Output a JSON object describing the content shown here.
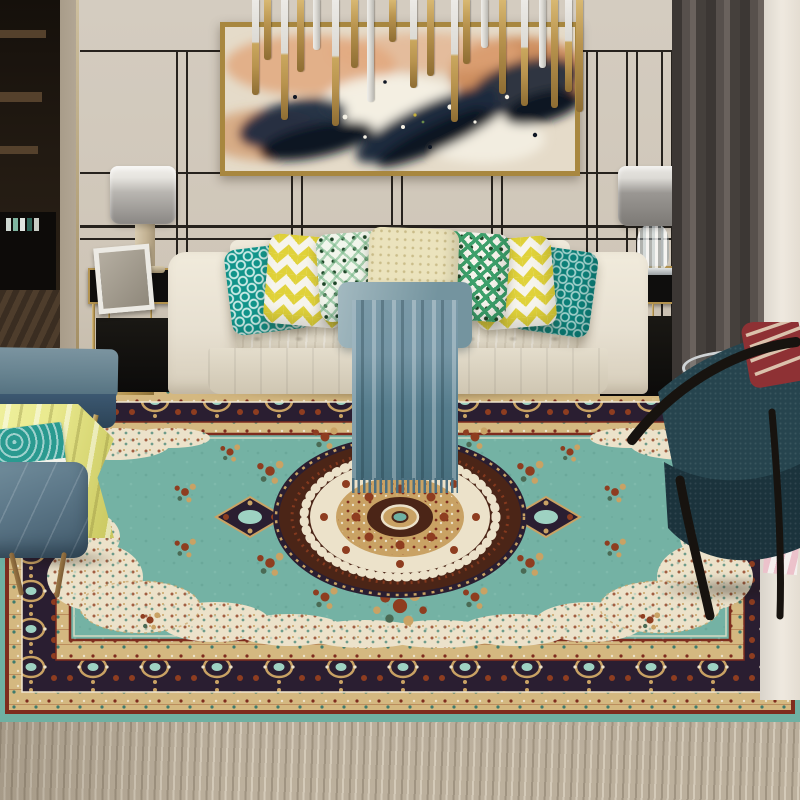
{
  "scene": {
    "title": "Modern living room with teal Persian medallion area rug",
    "objects": [
      {
        "name": "abstract-wall-art",
        "description": "gold-framed abstract painting with navy, peach-orange and white paint splashes"
      },
      {
        "name": "pendant-chandelier",
        "description": "cluster of hanging brass and silver cylindrical rods"
      },
      {
        "name": "wall-panel-trim",
        "description": "cream wall with thin black and gold line moulding"
      },
      {
        "name": "table-lamp-left",
        "description": "drum-shade lamp with alabaster column base on gold side table"
      },
      {
        "name": "table-lamp-right",
        "description": "drum-shade lamp with crystal base on gold side table"
      },
      {
        "name": "photo-frame",
        "description": "small white picture frame on left side table"
      },
      {
        "name": "sofa",
        "description": "cream tufted three-seat sofa"
      },
      {
        "name": "throw-pillows",
        "description": "seven pillows: teal lattice, yellow chevron, green dot-diamond, cream, green diamond, yellow chevron, dark teal lattice"
      },
      {
        "name": "throw-blanket",
        "description": "slate blue draped throw with fringe"
      },
      {
        "name": "area-rug",
        "description": "teal-green Persian rug with ornate cream/maroon center medallion and dark navy floral border"
      },
      {
        "name": "bench-and-stool",
        "description": "blue-gray leather bench and stool with yellow towel and teal book"
      },
      {
        "name": "armchair",
        "description": "dark teal fabric armchair with black wood frame and red striped pillow"
      },
      {
        "name": "magazines",
        "description": "magazines on round glass side table"
      },
      {
        "name": "curtain",
        "description": "dark gray curtain beside bright window sheer"
      },
      {
        "name": "wood-floor",
        "description": "light washed-gray plank flooring"
      }
    ]
  },
  "palette": {
    "wall": "#d4ccc0",
    "wall_shade": "#b3a795",
    "trim_dark": "#26221d",
    "gold": "#b2924e",
    "trim_gold": "#8f7640",
    "door_dark": "#221a12",
    "door_shelf": "#55412c",
    "floor": "#b5a996",
    "floor_dark": "#8e8270",
    "floor_light": "#d8cfbf",
    "curtain": "#49423f",
    "curtain_light": "#6a625d",
    "sheer": "#efe9df",
    "canvas": "#e5dbc9",
    "paint_navy": "#1e2a3e",
    "paint_navy2": "#0e1624",
    "paint_orange": "#c97c44",
    "paint_peach": "#e2a87e",
    "paint_white": "#f4f0e4",
    "frame_gold": "#a8873f",
    "rod_gold": "#b8934e",
    "rod_gold_dark": "#8e6d33",
    "rod_silver": "#dcdad4",
    "shade_light": "#e6e4df",
    "shade_dark": "#8a8784",
    "lamp_column": "#c4b394",
    "table_black": "#0f0e0d",
    "sofa": "#e7e0d1",
    "sofa_shade": "#c9bfab",
    "sofa_dark": "#b5aa94",
    "p_teal": "#11948a",
    "p_teal_dark": "#0c7f78",
    "p_yellow": "#e0d23a",
    "p_white": "#f6f4ec",
    "p_green": "#3da06b",
    "p_green_dark": "#1d4527",
    "p_ltgreen": "#79b98a",
    "p_cream": "#ebe3bd",
    "throw": "#7596a5",
    "throw_dark": "#4d7080",
    "throw_light": "#a3b9c0",
    "rug_selvage": "#6fb0a2",
    "rug_field": "#74b2a4",
    "rug_navy": "#2a1e31",
    "rug_maroon": "#4b2517",
    "rug_cream": "#ece2ca",
    "rug_gold": "#c9a264",
    "rug_beige": "#d4b880",
    "rug_rust": "#8e3d20",
    "rug_red": "#7e2c1e",
    "rug_teal_accent": "#9ed2c2",
    "bench_top": "#66828f",
    "bench_front": "#3c5871",
    "towel": "#e9e98e",
    "towel_dark": "#c9c75e",
    "book_teal": "#2a9a90",
    "stool": "#5d7889",
    "stool_dark": "#41596a",
    "bronze": "#7c5c35",
    "chair_teal": "#26444e",
    "chair_teal_dark": "#1b333c",
    "chair_frame": "#17130f",
    "pillow_red": "#8e3134",
    "pillow_red_cream": "#e9dcc2",
    "magazine": "#e9e6df",
    "magazine_red": "#b23a35",
    "pink": "#ecc2cb",
    "glass": "#cfd3d5"
  }
}
